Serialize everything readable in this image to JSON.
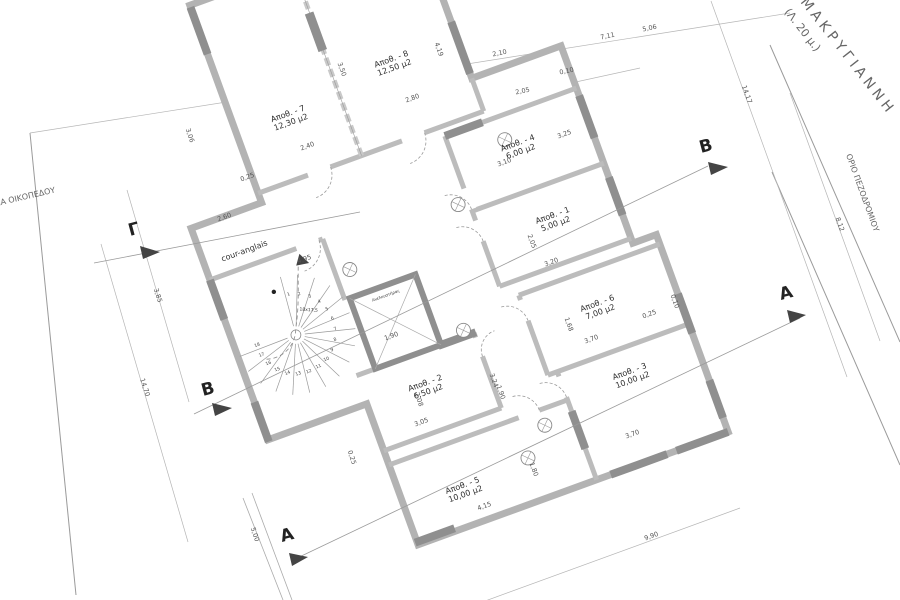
{
  "site": {
    "street_name": "ΜΑΚΡΥΓΙΑΝΝΗ",
    "street_width_note": "(Λ. 20 μ.)",
    "plot_boundary_label": "ΟΡΙΑ ΟΙΚΟΠΕΔΟΥ",
    "sidewalk_boundary_label": "ΟΡΙΟ ΠΕΖΟΔΡΟΜΙΟΥ"
  },
  "plan": {
    "rotation_deg": -20,
    "court_label": "cour-anglais",
    "elevator_label": "Ανελκυστήρας",
    "stair_note": "18x17,5",
    "rooms": [
      {
        "id": "room-7",
        "name": "Αποθ. - 7",
        "area": "12,30 μ2",
        "x": 50,
        "y": 78
      },
      {
        "id": "room-8",
        "name": "Αποθ. - 8",
        "area": "12,50 μ2",
        "x": 166,
        "y": 62
      },
      {
        "id": "room-4",
        "name": "Αποθ. - 4",
        "area": "6,00 μ2",
        "x": 256,
        "y": 184
      },
      {
        "id": "room-1",
        "name": "Αποθ. - 1",
        "area": "5,00 μ2",
        "x": 264,
        "y": 264
      },
      {
        "id": "room-6",
        "name": "Αποθ. - 6",
        "area": "7,00 μ2",
        "x": 276,
        "y": 362
      },
      {
        "id": "room-3",
        "name": "Αποθ. - 3",
        "area": "10,00 μ2",
        "x": 283,
        "y": 437
      },
      {
        "id": "room-2",
        "name": "Αποθ. - 2",
        "area": "6,50 μ2",
        "x": 87,
        "y": 378
      },
      {
        "id": "room-5",
        "name": "Αποθ. - 5",
        "area": "10,00 μ2",
        "x": 87,
        "y": 487
      }
    ],
    "stair_numbers": [
      "1",
      "2",
      "3",
      "4",
      "5",
      "6",
      "7",
      "8",
      "9",
      "10",
      "11",
      "12",
      "13",
      "14",
      "15",
      "16",
      "17",
      "18"
    ],
    "section_markers": [
      {
        "label": "Γ",
        "x": 130,
        "y": 236,
        "r": -15,
        "tri": "140,246 160,252 143,259",
        "line": [
          94,
          263,
          360,
          212
        ]
      },
      {
        "label": "B",
        "x": 203,
        "y": 396,
        "r": -15,
        "tri": "212,403 232,408 215,416",
        "line": [
          194,
          414,
          708,
          166
        ]
      },
      {
        "label": "B",
        "x": 701,
        "y": 153,
        "r": -15,
        "tri": "708,162 728,167 711,175",
        "line": null
      },
      {
        "label": "A",
        "x": 781,
        "y": 300,
        "r": -15,
        "tri": "787,310 806,315 790,323",
        "line": [
          293,
          560,
          800,
          318
        ]
      },
      {
        "label": "A",
        "x": 282,
        "y": 542,
        "r": -15,
        "tri": "289,553 308,557 292,566",
        "line": null
      }
    ],
    "dimensions": [
      {
        "t": "2,10",
        "x": 500,
        "y": 55,
        "r": -12
      },
      {
        "t": "7,11",
        "x": 608,
        "y": 38,
        "r": -12
      },
      {
        "t": "5,06",
        "x": 650,
        "y": 30,
        "r": -12
      },
      {
        "t": "0,10",
        "x": 567,
        "y": 73,
        "r": -12
      },
      {
        "t": "2,05",
        "x": 523,
        "y": 93,
        "r": -12
      },
      {
        "t": "14,17",
        "x": 745,
        "y": 95,
        "r": 70
      },
      {
        "t": "8,12",
        "x": 838,
        "y": 225,
        "r": 70
      },
      {
        "t": "14,70",
        "x": 143,
        "y": 388,
        "r": 72
      },
      {
        "t": "3,85",
        "x": 156,
        "y": 296,
        "r": 72
      },
      {
        "t": "3,06",
        "x": 188,
        "y": 136,
        "r": 72
      },
      {
        "t": "3,50",
        "x": 340,
        "y": 70,
        "r": 70
      },
      {
        "t": "4,19",
        "x": 437,
        "y": 50,
        "r": 70
      },
      {
        "t": "2,80",
        "x": 413,
        "y": 100,
        "r": -20
      },
      {
        "t": "2,40",
        "x": 308,
        "y": 148,
        "r": -20
      },
      {
        "t": "0,25",
        "x": 248,
        "y": 179,
        "r": -20
      },
      {
        "t": "2,60",
        "x": 225,
        "y": 219,
        "r": -20
      },
      {
        "t": "4,95",
        "x": 305,
        "y": 261,
        "r": -20
      },
      {
        "t": "3,10",
        "x": 505,
        "y": 164,
        "r": -20
      },
      {
        "t": "3,25",
        "x": 565,
        "y": 136,
        "r": -20
      },
      {
        "t": "2,05",
        "x": 530,
        "y": 242,
        "r": 70
      },
      {
        "t": "3,20",
        "x": 552,
        "y": 264,
        "r": -20
      },
      {
        "t": "1,68",
        "x": 567,
        "y": 325,
        "r": 70
      },
      {
        "t": "3,70",
        "x": 592,
        "y": 341,
        "r": -20
      },
      {
        "t": "0,25",
        "x": 650,
        "y": 316,
        "r": -20
      },
      {
        "t": "0,10",
        "x": 673,
        "y": 302,
        "r": 70
      },
      {
        "t": "3,70",
        "x": 633,
        "y": 436,
        "r": -20
      },
      {
        "t": "2,08",
        "x": 417,
        "y": 400,
        "r": 72
      },
      {
        "t": "3,05",
        "x": 422,
        "y": 424,
        "r": -20
      },
      {
        "t": "3,24",
        "x": 492,
        "y": 381,
        "r": 70
      },
      {
        "t": "1,90",
        "x": 499,
        "y": 393,
        "r": 70
      },
      {
        "t": "0,25",
        "x": 350,
        "y": 458,
        "r": 72
      },
      {
        "t": "1,90",
        "x": 392,
        "y": 338,
        "r": -20
      },
      {
        "t": "4,15",
        "x": 485,
        "y": 508,
        "r": -20
      },
      {
        "t": "1,80",
        "x": 532,
        "y": 470,
        "r": 70
      },
      {
        "t": "9,90",
        "x": 652,
        "y": 538,
        "r": -20
      },
      {
        "t": "5,00",
        "x": 253,
        "y": 535,
        "r": 72
      }
    ]
  }
}
